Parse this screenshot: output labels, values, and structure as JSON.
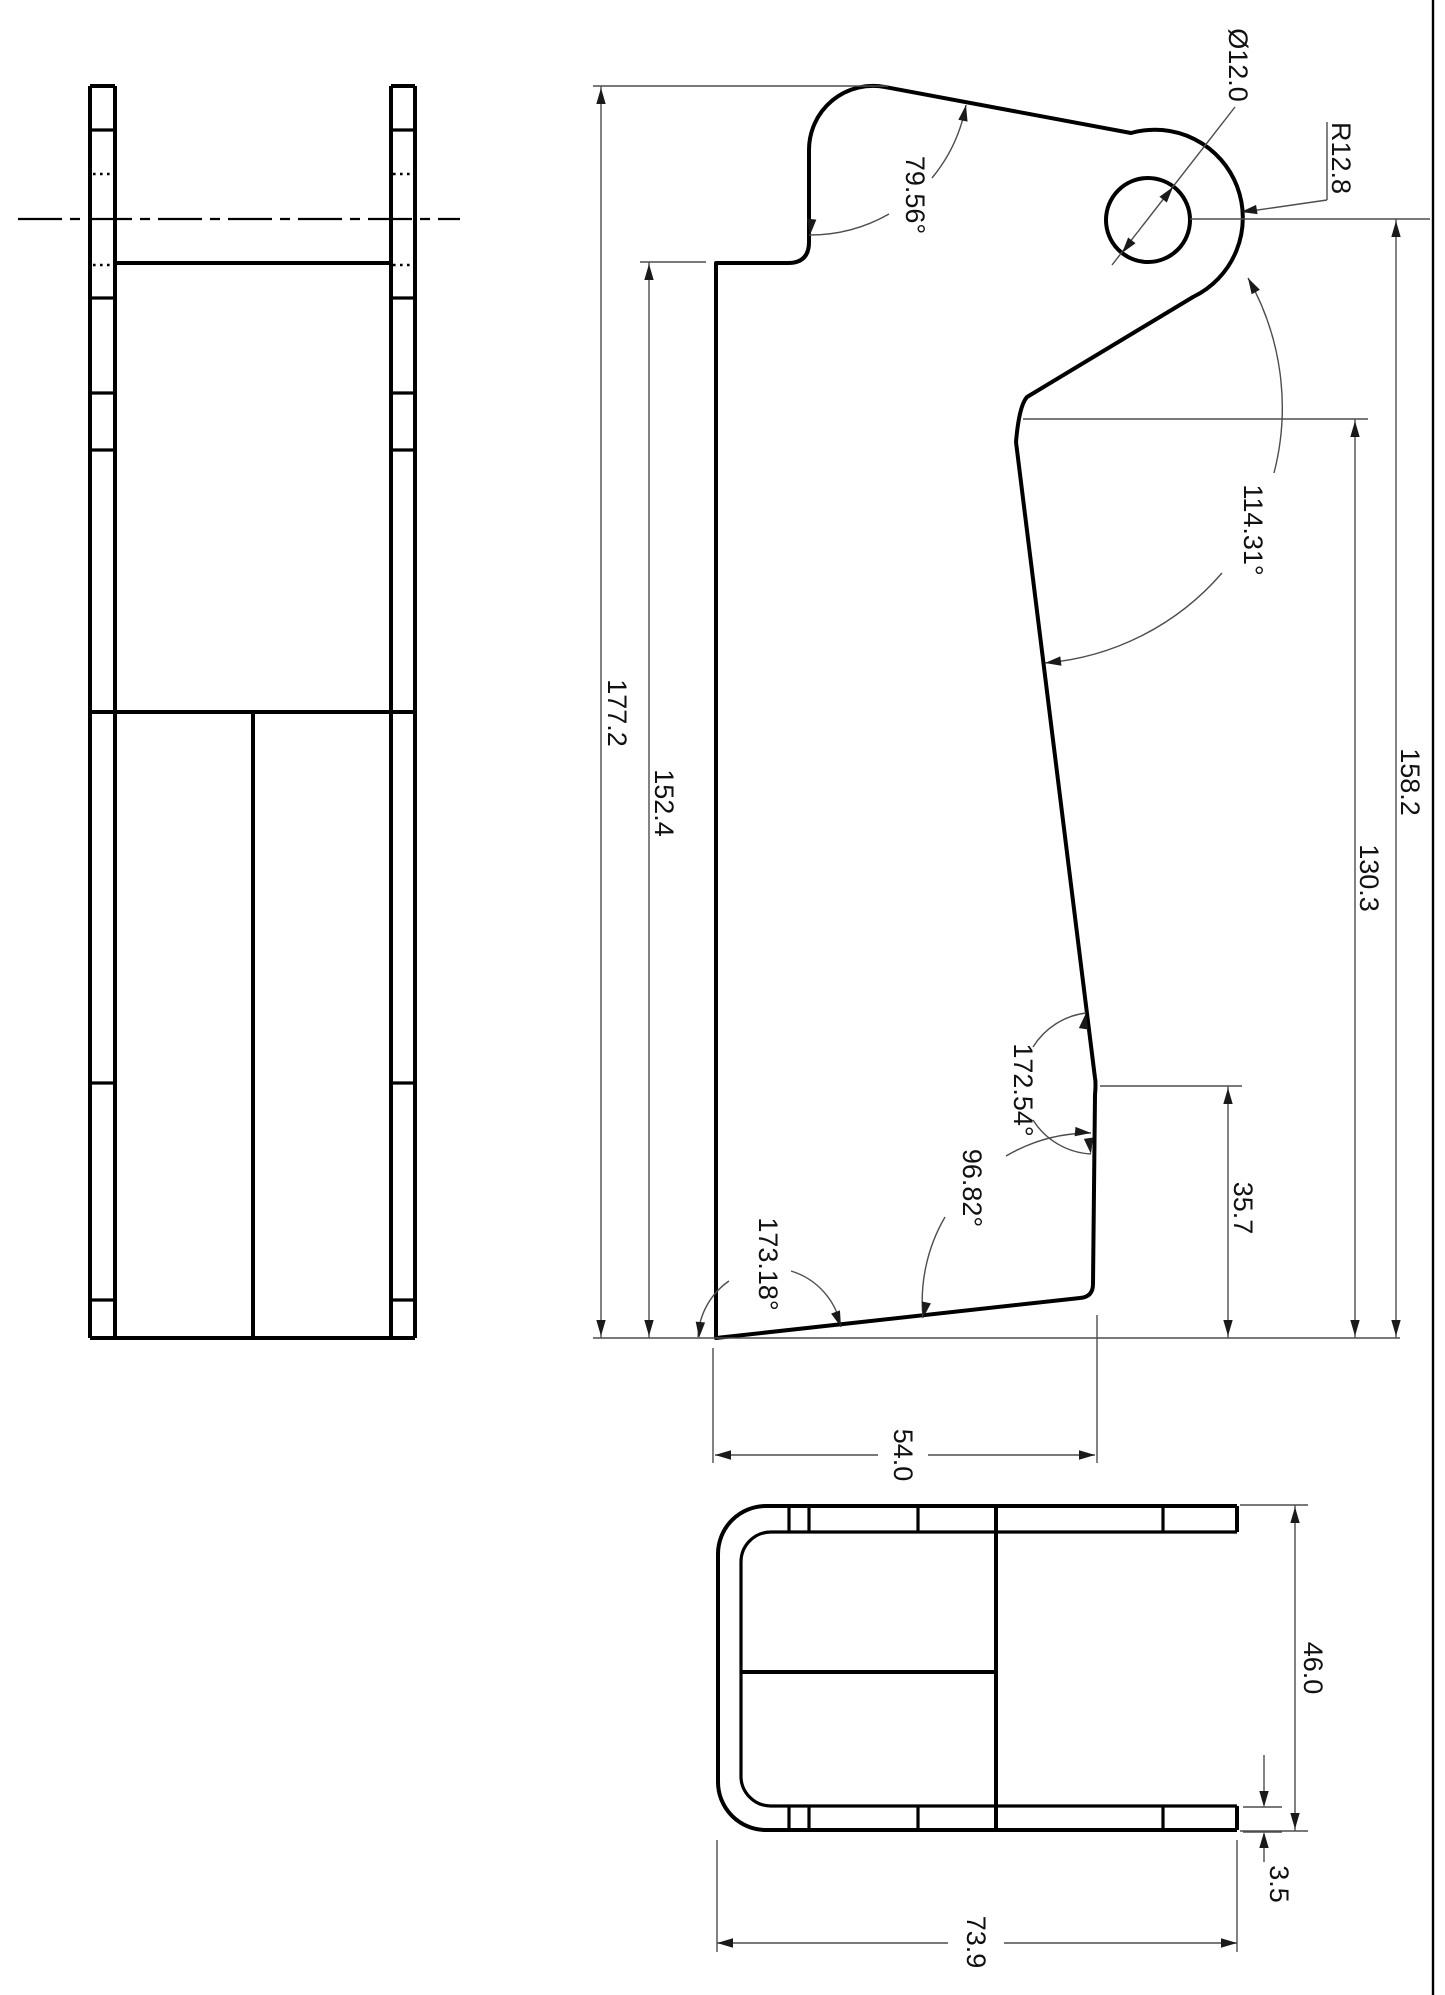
{
  "page": {
    "background": "#ffffff",
    "line_color": "#000000",
    "annotation_color": "#4d4d4d",
    "frame_color": "#000000"
  },
  "drawing": {
    "type": "engineering-drawing",
    "views": {
      "front": "front-view",
      "side": "side-profile-view",
      "bottom": "bottom-view"
    },
    "dimensions": {
      "overall_height": "177.2",
      "step_height": "152.4",
      "hole_center_height": "158.2",
      "bend_height": "130.3",
      "right_edge_height": "35.7",
      "base_width": "54.0",
      "overall_length": "73.9",
      "channel_width": "46.0",
      "thickness": "3.5",
      "hole_diameter": "Ø12.0",
      "tip_radius": "R12.8",
      "angle_top": "79.56°",
      "angle_upper_bend": "114.31°",
      "angle_lower_bend": "172.54°",
      "angle_bottom_right": "96.82°",
      "angle_bottom_left": "173.18°"
    }
  }
}
